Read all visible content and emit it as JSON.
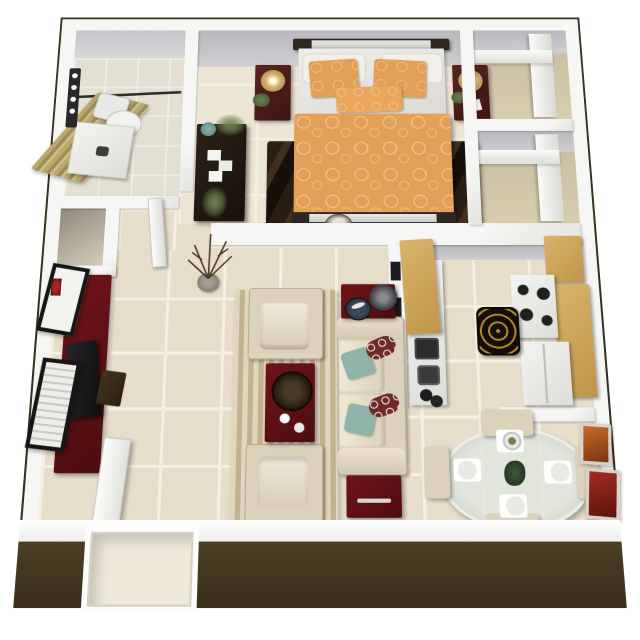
{
  "scene": {
    "type": "3d-floorplan",
    "description": "Top-down 3D dollhouse rendering of a one-bedroom, one-bathroom apartment floor plan with furnished rooms",
    "rooms": [
      {
        "name": "bathroom",
        "position": "top-left",
        "furniture": [
          "shower-with-tan-curtain",
          "curtain-rod",
          "toilet",
          "vanity-with-sink",
          "mirror-light-bar"
        ]
      },
      {
        "name": "linen-closet",
        "position": "below-bathroom",
        "furniture": []
      },
      {
        "name": "hallway",
        "position": "left-center",
        "furniture": [
          "bedroom-door-leaf"
        ]
      },
      {
        "name": "bedroom",
        "position": "top-center",
        "furniture": [
          "bed-with-orange-bedding",
          "orange-accent-pillows",
          "white-pillows",
          "nightstand-left",
          "nightstand-right",
          "table-lamps",
          "dresser-with-plants",
          "dark-brown-area-rug",
          "wall-dome-vent"
        ]
      },
      {
        "name": "closets",
        "position": "top-right",
        "furniture": [
          "white-shelving-closet-1",
          "white-shelving-closet-2"
        ]
      },
      {
        "name": "living-room",
        "position": "bottom-left-center",
        "furniture": [
          "maroon-tv-console",
          "television",
          "media-shelf",
          "wall-art-frames",
          "armchair-top",
          "armchair-bottom",
          "sofa-with-teal-and-patterned-pillows",
          "maroon-coffee-table-with-tray-and-cups",
          "end-table-with-lamp-and-plate",
          "end-table-bottom",
          "striped-beige-rug",
          "twig-vase"
        ]
      },
      {
        "name": "kitchen",
        "position": "right-center",
        "furniture": [
          "tan-upper-cabinets",
          "white-counter",
          "microwave",
          "sink",
          "stove-with-burners",
          "refrigerator",
          "tan-cabinets-east",
          "black-gold-spiral-rug"
        ]
      },
      {
        "name": "dining-room",
        "position": "bottom-right",
        "furniture": [
          "oval-glass-table",
          "four-place-settings",
          "centerpiece-plant",
          "four-beige-chairs",
          "two-wall-paintings"
        ]
      },
      {
        "name": "entry",
        "position": "bottom",
        "furniture": [
          "front-door-opening",
          "open-door-leaf"
        ]
      }
    ],
    "colors": {
      "wall": "#f6f6f4",
      "outline": "#35301f",
      "exterior": "#4c3e24",
      "gray_wall": "#b9b8bd",
      "tile": "#e7deca",
      "grout": "#f4efe2",
      "tile_bedroom": "#ece5d4",
      "maroon": "#701318",
      "maroon_dark": "#4d0d10",
      "beige": "#dcd2bc",
      "orange": "#e2a058",
      "orange_light": "#f0bd80",
      "teal": "#8fb4a9",
      "tan_cabinet": "#d9b46c",
      "tan_cabinet_dark": "#bf9448",
      "curtain": "#b9a76f",
      "curtain_dark": "#9c8c55",
      "dark_rug": "#2a1d12",
      "living_rug": "#cdbb98",
      "green": "#6d8050",
      "gold": "#b5852f",
      "art_orange": "#c96a2d",
      "art_red": "#a32c22"
    }
  }
}
